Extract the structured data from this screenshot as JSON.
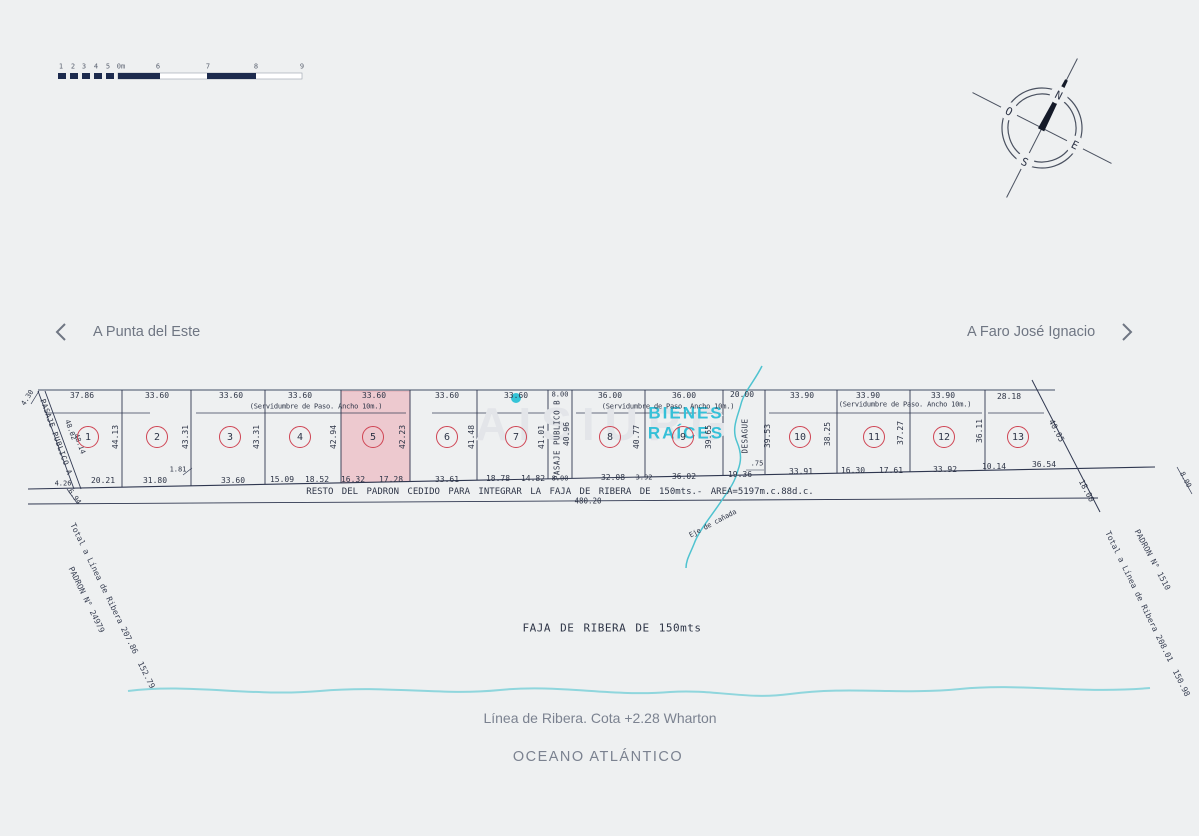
{
  "nav": {
    "left": "A Punta del Este",
    "right": "A Faro José Ignacio"
  },
  "compass": {
    "n": "N",
    "s": "S",
    "e": "E",
    "o": "O"
  },
  "watermark": {
    "text": "AISIURG",
    "line1": "BIENES",
    "line2": "RAÍCES"
  },
  "colors": {
    "line": "#3a4258",
    "road": "#7c8494",
    "accent_red": "#cf4453",
    "lot5_fill": "#edc9cf",
    "stream": "#4fc3d0",
    "shore": "#8fd6dd",
    "cyan_brand": "#35c0d8",
    "gray_text": "#7b8290",
    "scale_dark": "#1d2b4e"
  },
  "plan": {
    "resto_text": "RESTO DEL PADRON CEDIDO PARA INTEGRAR LA FAJA DE RIBERA DE 150mts.- AREA=5197m.c.88d.c.",
    "resto_total": "480.20",
    "faja_label": "FAJA DE RIBERA DE 150mts",
    "linea_label": "Línea de Ribera. Cota +2.28 Wharton",
    "oceano_label": "OCEANO ATLÁNTICO",
    "lots": [
      {
        "number": "1",
        "cx": 88,
        "cy": 437
      },
      {
        "number": "2",
        "cx": 157,
        "cy": 437
      },
      {
        "number": "3",
        "cx": 230,
        "cy": 437
      },
      {
        "number": "4",
        "cx": 300,
        "cy": 437
      },
      {
        "number": "5",
        "cx": 373,
        "cy": 437
      },
      {
        "number": "6",
        "cx": 447,
        "cy": 437
      },
      {
        "number": "7",
        "cx": 516,
        "cy": 437
      },
      {
        "number": "8",
        "cx": 610,
        "cy": 437
      },
      {
        "number": "9",
        "cx": 683,
        "cy": 437
      },
      {
        "number": "10",
        "cx": 800,
        "cy": 437
      },
      {
        "number": "11",
        "cx": 874,
        "cy": 437
      },
      {
        "number": "12",
        "cx": 944,
        "cy": 437
      },
      {
        "number": "13",
        "cx": 1018,
        "cy": 437
      }
    ],
    "labels": [
      {
        "n": "scale-num",
        "t": "1",
        "x": 61,
        "y": 67,
        "k": "tick"
      },
      {
        "n": "scale-num",
        "t": "2",
        "x": 73,
        "y": 67,
        "k": "tick"
      },
      {
        "n": "scale-num",
        "t": "3",
        "x": 84,
        "y": 67,
        "k": "tick"
      },
      {
        "n": "scale-num",
        "t": "4",
        "x": 96,
        "y": 67,
        "k": "tick"
      },
      {
        "n": "scale-num",
        "t": "5",
        "x": 108,
        "y": 67,
        "k": "tick"
      },
      {
        "n": "scale-num",
        "t": "0m",
        "x": 121,
        "y": 67,
        "k": "tick"
      },
      {
        "n": "scale-num",
        "t": "6",
        "x": 158,
        "y": 67,
        "k": "tick"
      },
      {
        "n": "scale-num",
        "t": "7",
        "x": 208,
        "y": 67,
        "k": "tick"
      },
      {
        "n": "scale-num",
        "t": "8",
        "x": 256,
        "y": 67,
        "k": "tick"
      },
      {
        "n": "scale-num",
        "t": "9",
        "x": 302,
        "y": 67,
        "k": "tick"
      },
      {
        "n": "dim-top",
        "t": "4.30",
        "x": 28,
        "y": 398,
        "r": -58,
        "k": "dim-sm"
      },
      {
        "n": "dim-top",
        "t": "37.86",
        "x": 82,
        "y": 396,
        "k": "dim"
      },
      {
        "n": "dim-top",
        "t": "33.60",
        "x": 157,
        "y": 396,
        "k": "dim"
      },
      {
        "n": "dim-top",
        "t": "33.60",
        "x": 231,
        "y": 396,
        "k": "dim"
      },
      {
        "n": "dim-top",
        "t": "33.60",
        "x": 300,
        "y": 396,
        "k": "dim"
      },
      {
        "n": "dim-top",
        "t": "33.60",
        "x": 374,
        "y": 396,
        "k": "dim"
      },
      {
        "n": "dim-top",
        "t": "33.60",
        "x": 447,
        "y": 396,
        "k": "dim"
      },
      {
        "n": "dim-top",
        "t": "33.60",
        "x": 516,
        "y": 396,
        "k": "dim"
      },
      {
        "n": "dim-top",
        "t": "8.00",
        "x": 560,
        "y": 395,
        "k": "dim-sm"
      },
      {
        "n": "dim-top",
        "t": "36.00",
        "x": 610,
        "y": 396,
        "k": "dim"
      },
      {
        "n": "dim-top",
        "t": "36.00",
        "x": 684,
        "y": 396,
        "k": "dim"
      },
      {
        "n": "dim-top",
        "t": "20.00",
        "x": 742,
        "y": 395,
        "k": "dim"
      },
      {
        "n": "dim-top",
        "t": "33.90",
        "x": 802,
        "y": 396,
        "k": "dim"
      },
      {
        "n": "dim-top",
        "t": "33.90",
        "x": 868,
        "y": 396,
        "k": "dim"
      },
      {
        "n": "dim-top",
        "t": "33.90",
        "x": 943,
        "y": 396,
        "k": "dim"
      },
      {
        "n": "dim-top",
        "t": "28.18",
        "x": 1009,
        "y": 397,
        "k": "dim"
      },
      {
        "n": "servidumbre-label",
        "t": "(Servidumbre de Paso. Ancho 10m.)",
        "x": 316,
        "y": 407,
        "k": "serv"
      },
      {
        "n": "servidumbre-label",
        "t": "(Servidumbre de Paso. Ancho 10m.)",
        "x": 668,
        "y": 407,
        "k": "serv"
      },
      {
        "n": "servidumbre-label",
        "t": "(Servidumbre de Paso. Ancho 10m.)",
        "x": 905,
        "y": 405,
        "k": "serv"
      },
      {
        "n": "dim-side",
        "t": "44.13",
        "x": 116,
        "y": 437,
        "r": -90,
        "k": "dim"
      },
      {
        "n": "dim-side",
        "t": "43.31",
        "x": 186,
        "y": 437,
        "r": -90,
        "k": "dim"
      },
      {
        "n": "dim-side",
        "t": "43.31",
        "x": 257,
        "y": 437,
        "r": -90,
        "k": "dim"
      },
      {
        "n": "dim-side",
        "t": "42.94",
        "x": 334,
        "y": 437,
        "r": -90,
        "k": "dim"
      },
      {
        "n": "dim-side",
        "t": "42.23",
        "x": 403,
        "y": 437,
        "r": -90,
        "k": "dim"
      },
      {
        "n": "dim-side",
        "t": "41.48",
        "x": 472,
        "y": 437,
        "r": -90,
        "k": "dim"
      },
      {
        "n": "dim-side",
        "t": "41.01",
        "x": 542,
        "y": 437,
        "r": -90,
        "k": "dim"
      },
      {
        "n": "dim-side",
        "t": "40.96",
        "x": 567,
        "y": 434,
        "r": -90,
        "k": "dim"
      },
      {
        "n": "dim-side",
        "t": "40.77",
        "x": 637,
        "y": 437,
        "r": -90,
        "k": "dim"
      },
      {
        "n": "dim-side",
        "t": "39.65",
        "x": 709,
        "y": 437,
        "r": -90,
        "k": "dim"
      },
      {
        "n": "dim-side",
        "t": "39.53",
        "x": 768,
        "y": 436,
        "r": -90,
        "k": "dim"
      },
      {
        "n": "dim-side",
        "t": "38.25",
        "x": 828,
        "y": 434,
        "r": -90,
        "k": "dim"
      },
      {
        "n": "dim-side",
        "t": "37.27",
        "x": 901,
        "y": 433,
        "r": -90,
        "k": "dim"
      },
      {
        "n": "dim-side",
        "t": "36.11",
        "x": 980,
        "y": 431,
        "r": -90,
        "k": "dim"
      },
      {
        "n": "pasaje-publico-b-label",
        "t": "PASAJE PUBLICO B",
        "x": 557,
        "y": 440,
        "r": -90,
        "k": "name"
      },
      {
        "n": "desague-label",
        "t": "DESAGUE",
        "x": 745,
        "y": 436,
        "r": -90,
        "k": "name"
      },
      {
        "n": "pasaje-publico-a-label",
        "t": "PASAJE PUBLICO A",
        "x": 56,
        "y": 437,
        "r": 70,
        "k": "name"
      },
      {
        "n": "dim-diag",
        "t": "48.02",
        "x": 70,
        "y": 430,
        "r": 70,
        "k": "dim-sm"
      },
      {
        "n": "dim-diag",
        "t": "48.14",
        "x": 79,
        "y": 444,
        "r": 70,
        "k": "dim-sm"
      },
      {
        "n": "dim-bottom",
        "t": "4.26",
        "x": 63,
        "y": 484,
        "k": "dim-sm"
      },
      {
        "n": "dim-bottom",
        "t": "6.94",
        "x": 74,
        "y": 497,
        "r": 55,
        "k": "dim-sm"
      },
      {
        "n": "dim-bottom",
        "t": "20.21",
        "x": 103,
        "y": 481,
        "k": "dim"
      },
      {
        "n": "dim-bottom",
        "t": "31.80",
        "x": 155,
        "y": 481,
        "k": "dim"
      },
      {
        "n": "dim-bottom",
        "t": "1.81",
        "x": 178,
        "y": 470,
        "k": "dim-sm"
      },
      {
        "n": "dim-bottom",
        "t": "33.60",
        "x": 233,
        "y": 481,
        "k": "dim"
      },
      {
        "n": "dim-bottom",
        "t": "15.09",
        "x": 282,
        "y": 480,
        "k": "dim"
      },
      {
        "n": "dim-bottom",
        "t": "18.52",
        "x": 317,
        "y": 480,
        "k": "dim"
      },
      {
        "n": "dim-bottom",
        "t": "16.32",
        "x": 353,
        "y": 480,
        "k": "dim"
      },
      {
        "n": "dim-bottom",
        "t": "17.28",
        "x": 391,
        "y": 480,
        "k": "dim"
      },
      {
        "n": "dim-bottom",
        "t": "33.61",
        "x": 447,
        "y": 480,
        "k": "dim"
      },
      {
        "n": "dim-bottom",
        "t": "18.78",
        "x": 498,
        "y": 479,
        "k": "dim"
      },
      {
        "n": "dim-bottom",
        "t": "14.82",
        "x": 533,
        "y": 479,
        "k": "dim"
      },
      {
        "n": "dim-bottom",
        "t": "8.00",
        "x": 560,
        "y": 479,
        "k": "dim-sm"
      },
      {
        "n": "dim-bottom",
        "t": "32.08",
        "x": 613,
        "y": 478,
        "k": "dim"
      },
      {
        "n": "dim-bottom",
        "t": "3.92",
        "x": 644,
        "y": 478,
        "k": "dim-sm"
      },
      {
        "n": "dim-bottom",
        "t": "36.02",
        "x": 684,
        "y": 477,
        "k": "dim"
      },
      {
        "n": "dim-bottom",
        "t": "19.36",
        "x": 740,
        "y": 475,
        "k": "dim"
      },
      {
        "n": "dim-bottom",
        "t": ".75",
        "x": 757,
        "y": 464,
        "k": "dim-sm"
      },
      {
        "n": "dim-bottom",
        "t": "33.91",
        "x": 801,
        "y": 472,
        "k": "dim"
      },
      {
        "n": "dim-bottom",
        "t": "16.30",
        "x": 853,
        "y": 471,
        "k": "dim"
      },
      {
        "n": "dim-bottom",
        "t": "17.61",
        "x": 891,
        "y": 471,
        "k": "dim"
      },
      {
        "n": "dim-bottom",
        "t": "33.92",
        "x": 945,
        "y": 470,
        "k": "dim"
      },
      {
        "n": "dim-bottom",
        "t": "10.14",
        "x": 994,
        "y": 467,
        "k": "dim"
      },
      {
        "n": "dim-bottom",
        "t": "36.54",
        "x": 1044,
        "y": 465,
        "k": "dim"
      },
      {
        "n": "dim-diag",
        "t": "40.05",
        "x": 1056,
        "y": 431,
        "r": 62,
        "k": "dim"
      },
      {
        "n": "dim-diag",
        "t": "18.00",
        "x": 1086,
        "y": 491,
        "r": 62,
        "k": "dim"
      },
      {
        "n": "dim-diag",
        "t": "8.00",
        "x": 1185,
        "y": 480,
        "r": 62,
        "k": "dim-sm"
      },
      {
        "n": "eje-canada-label",
        "t": "Eje de cañada",
        "x": 713,
        "y": 524,
        "r": -28,
        "k": "serv"
      },
      {
        "n": "padron-left-label",
        "t": "PADRON N° 24979",
        "x": 86,
        "y": 600,
        "r": 64,
        "k": "corner"
      },
      {
        "n": "total-ribera-left-label",
        "t": "Total a Línea de Ribera 207.86  152.79",
        "x": 112,
        "y": 606,
        "r": 64,
        "k": "corner"
      },
      {
        "n": "padron-right-label",
        "t": "PADRON N° 1510",
        "x": 1152,
        "y": 560,
        "r": 62,
        "k": "corner"
      },
      {
        "n": "total-ribera-right-label",
        "t": "Total a Línea de Ribera 208.01  150.98",
        "x": 1147,
        "y": 614,
        "r": 64,
        "k": "corner"
      },
      {
        "n": "faja-ribera-label",
        "t": "FAJA DE RIBERA DE 150mts",
        "x": 612,
        "y": 628,
        "k": "faja"
      }
    ]
  }
}
